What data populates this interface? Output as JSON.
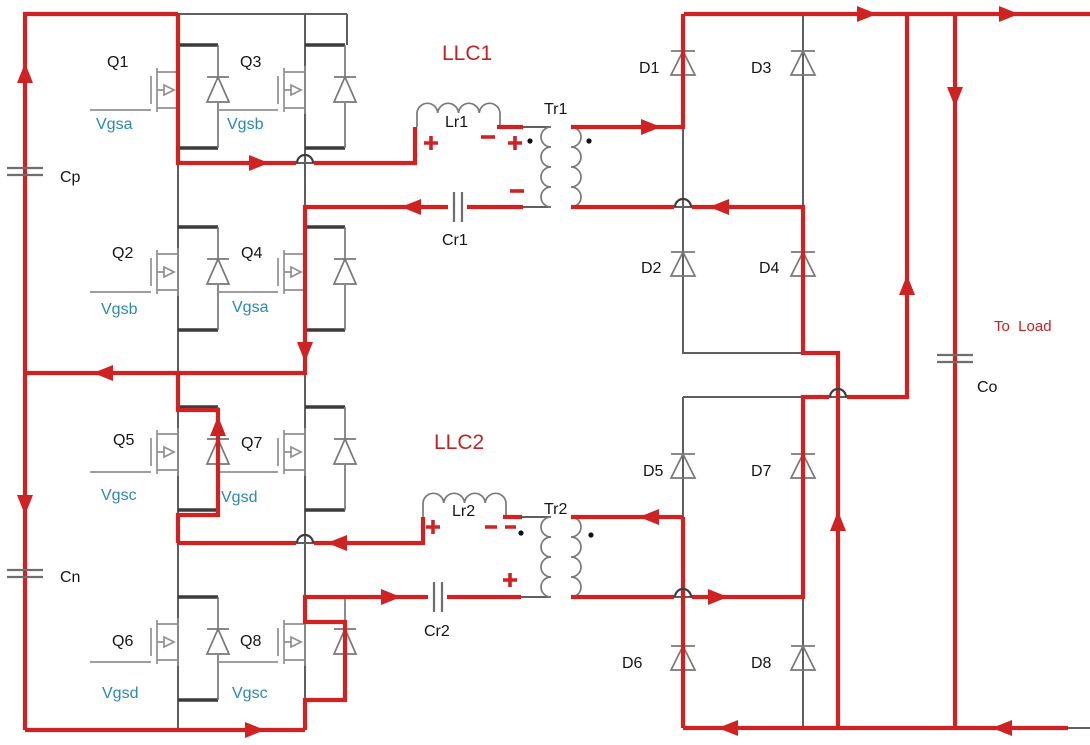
{
  "colors": {
    "current_path_red": "#cf2222",
    "red_text": "#bf2424",
    "wire_gray": "#5f5f5f",
    "dark_stub_gray": "#3b3b3b",
    "symbol_gray": "#909090",
    "gate_label_teal": "#2b89ad",
    "text_black": "#151515",
    "background": "#ffffff"
  },
  "labels": {
    "llc1": "LLC1",
    "llc2": "LLC2",
    "q1": "Q1",
    "q2": "Q2",
    "q3": "Q3",
    "q4": "Q4",
    "q5": "Q5",
    "q6": "Q6",
    "q7": "Q7",
    "q8": "Q8",
    "vgs_q1": "Vgsa",
    "vgs_q2": "Vgsb",
    "vgs_q3": "Vgsb",
    "vgs_q4": "Vgsa",
    "vgs_q5": "Vgsc",
    "vgs_q6": "Vgsd",
    "vgs_q7": "Vgsd",
    "vgs_q8": "Vgsc",
    "d1": "D1",
    "d2": "D2",
    "d3": "D3",
    "d4": "D4",
    "d5": "D5",
    "d6": "D6",
    "d7": "D7",
    "d8": "D8",
    "cap_p": "Cp",
    "cap_n": "Cn",
    "cap_o": "Co",
    "lr1": "Lr1",
    "cr1": "Cr1",
    "tr1": "Tr1",
    "lr2": "Lr2",
    "cr2": "Cr2",
    "tr2": "Tr2",
    "to_load": "To  Load"
  }
}
